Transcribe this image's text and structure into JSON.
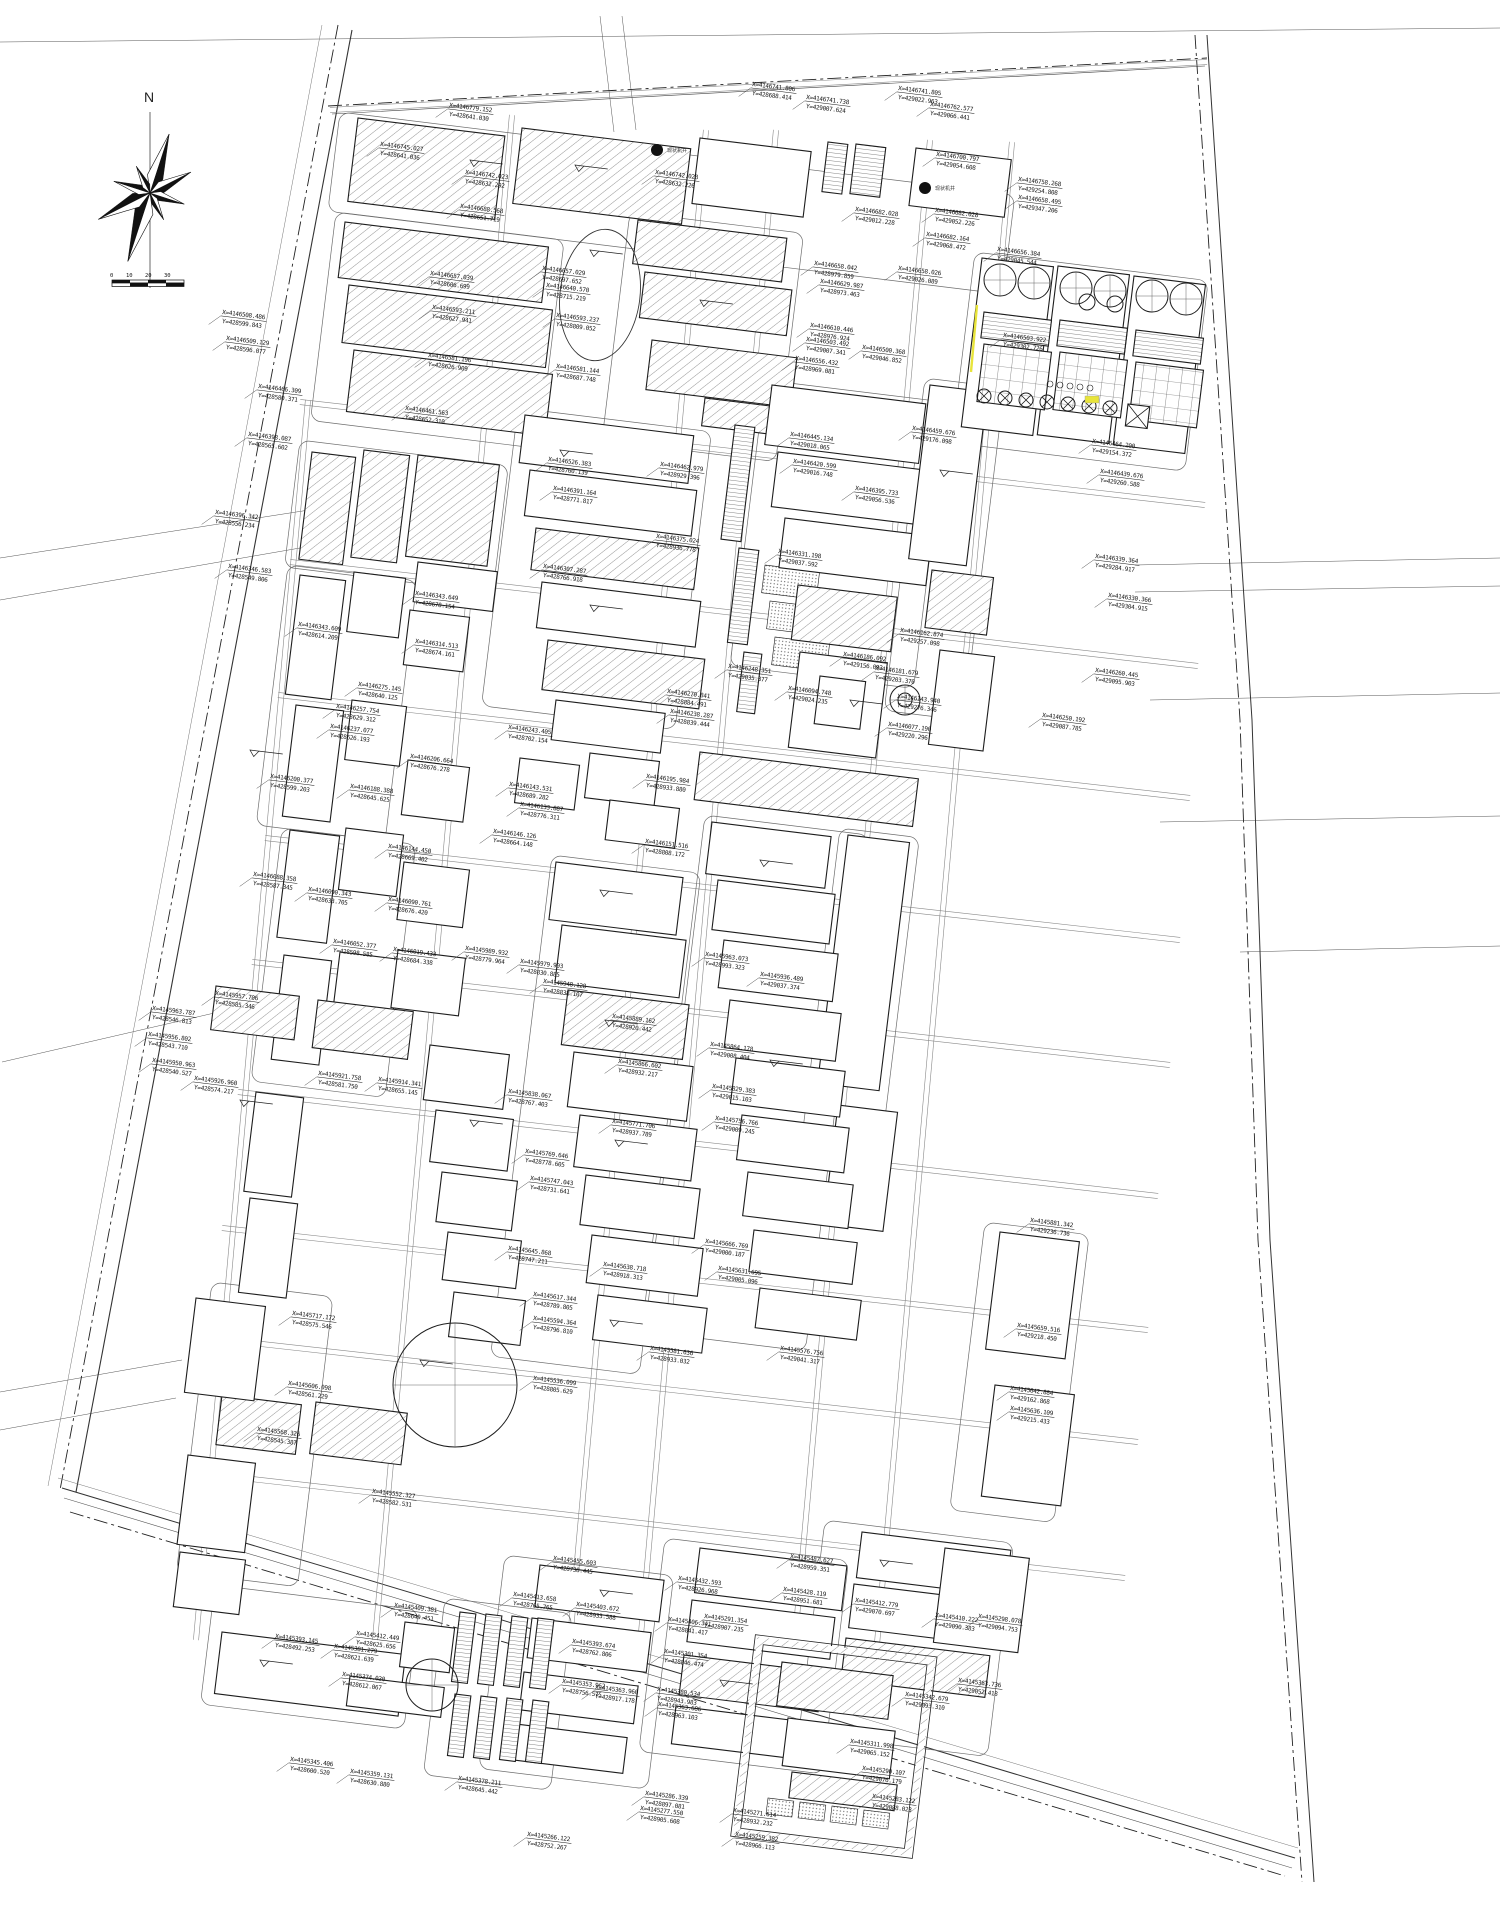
{
  "title": "industrial-plant-general-layout-site-plan",
  "compass": {
    "label": "N"
  },
  "scale_bar": {
    "ticks": [
      "0",
      "10",
      "20",
      "30"
    ]
  },
  "colors": {
    "background": "#ffffff",
    "line": "#1c1c1c",
    "road": "#8a8a8a",
    "highlight_yellow": "#e8e43a",
    "label_text": "#161616"
  },
  "markers": [
    {
      "x": 657,
      "y": 150,
      "text": "现状机井"
    },
    {
      "x": 925,
      "y": 188,
      "text": "现状机井"
    }
  ],
  "coordinate_label_fields": [
    "x",
    "y",
    "x_text",
    "y_text"
  ],
  "coordinate_labels": [
    [
      449,
      107,
      "X=4146779.152",
      "Y=428641.030"
    ],
    [
      380,
      146,
      "X=4146745.027",
      "Y=428641.036"
    ],
    [
      465,
      174,
      "X=4146742.023",
      "Y=428632.292"
    ],
    [
      655,
      174,
      "X=4146742.028",
      "Y=428632.226"
    ],
    [
      752,
      86,
      "X=4146741.806",
      "Y=428688.414"
    ],
    [
      806,
      99,
      "X=4146741.738",
      "Y=429007.624"
    ],
    [
      898,
      90,
      "X=4146741.805",
      "Y=429022.963"
    ],
    [
      930,
      106,
      "X=4146762.577",
      "Y=429066.441"
    ],
    [
      936,
      156,
      "X=4146700.797",
      "Y=429054.608"
    ],
    [
      1018,
      181,
      "X=4146758.268",
      "Y=429254.808"
    ],
    [
      1018,
      199,
      "X=4146658.495",
      "Y=429347.206"
    ],
    [
      460,
      208,
      "X=4146688.568",
      "Y=428651.719"
    ],
    [
      855,
      211,
      "X=4146682.028",
      "Y=429012.228"
    ],
    [
      935,
      212,
      "X=4146682.028",
      "Y=429052.226"
    ],
    [
      926,
      236,
      "X=4146682.164",
      "Y=429068.472"
    ],
    [
      997,
      251,
      "X=4146656.384",
      "Y=429045.544"
    ],
    [
      814,
      265,
      "X=4146658.042",
      "Y=428979.859"
    ],
    [
      898,
      270,
      "X=4146658.026",
      "Y=429026.089"
    ],
    [
      820,
      283,
      "X=4146629.987",
      "Y=428973.463"
    ],
    [
      430,
      275,
      "X=4146657.039",
      "Y=428606.699"
    ],
    [
      542,
      270,
      "X=4146657.029",
      "Y=428697.652"
    ],
    [
      546,
      287,
      "X=4146640.570",
      "Y=428715.219"
    ],
    [
      432,
      309,
      "X=4146593.211",
      "Y=428627.941"
    ],
    [
      556,
      317,
      "X=4146593.237",
      "Y=428809.052"
    ],
    [
      428,
      357,
      "X=4146581.196",
      "Y=428626.909"
    ],
    [
      556,
      368,
      "X=4146581.144",
      "Y=428687.748"
    ],
    [
      810,
      327,
      "X=4146610.446",
      "Y=428976.924"
    ],
    [
      795,
      360,
      "X=4146556.432",
      "Y=428969.081"
    ],
    [
      1003,
      337,
      "X=4146503.922",
      "Y=429302.726"
    ],
    [
      806,
      341,
      "X=4146503.492",
      "Y=429007.341"
    ],
    [
      862,
      349,
      "X=4146500.368",
      "Y=429046.852"
    ],
    [
      222,
      314,
      "X=4146508.486",
      "Y=428599.843"
    ],
    [
      226,
      340,
      "X=4146509.129",
      "Y=428596.077"
    ],
    [
      258,
      388,
      "X=4146466.309",
      "Y=428580.371"
    ],
    [
      248,
      436,
      "X=4146398.087",
      "Y=428565.602"
    ],
    [
      215,
      514,
      "X=4146396.342",
      "Y=428556.234"
    ],
    [
      228,
      568,
      "X=4146346.583",
      "Y=428549.806"
    ],
    [
      152,
      1010,
      "X=4145963.787",
      "Y=428546.813"
    ],
    [
      148,
      1036,
      "X=4145956.802",
      "Y=428543.710"
    ],
    [
      152,
      1062,
      "X=4145950.963",
      "Y=428540.527"
    ],
    [
      405,
      410,
      "X=4146461.563",
      "Y=428652.310"
    ],
    [
      415,
      595,
      "X=4146343.649",
      "Y=428678.154"
    ],
    [
      298,
      626,
      "X=4146343.609",
      "Y=428614.209"
    ],
    [
      415,
      643,
      "X=4146314.513",
      "Y=428674.161"
    ],
    [
      358,
      686,
      "X=4146275.145",
      "Y=428640.125"
    ],
    [
      336,
      708,
      "X=4146257.754",
      "Y=428629.312"
    ],
    [
      330,
      728,
      "X=4146237.077",
      "Y=428626.193"
    ],
    [
      410,
      758,
      "X=4146206.664",
      "Y=428676.278"
    ],
    [
      270,
      778,
      "X=4146200.377",
      "Y=428599.203"
    ],
    [
      350,
      788,
      "X=4146188.388",
      "Y=428645.625"
    ],
    [
      388,
      848,
      "X=4146144.450",
      "Y=428669.402"
    ],
    [
      253,
      876,
      "X=4146088.358",
      "Y=428587.345"
    ],
    [
      308,
      891,
      "X=4146090.343",
      "Y=428633.705"
    ],
    [
      388,
      901,
      "X=4146090.761",
      "Y=428676.420"
    ],
    [
      393,
      951,
      "X=4146019.433",
      "Y=428684.338"
    ],
    [
      548,
      461,
      "X=4146526.383",
      "Y=428760.139"
    ],
    [
      660,
      466,
      "X=4146462.979",
      "Y=428929.396"
    ],
    [
      553,
      490,
      "X=4146391.164",
      "Y=428771.817"
    ],
    [
      543,
      568,
      "X=4146307.287",
      "Y=428766.918"
    ],
    [
      656,
      538,
      "X=4146375.024",
      "Y=428936.778"
    ],
    [
      508,
      729,
      "X=4146243.405",
      "Y=428702.154"
    ],
    [
      509,
      786,
      "X=4146143.531",
      "Y=428689.282"
    ],
    [
      520,
      806,
      "X=4146133.887",
      "Y=428776.311"
    ],
    [
      493,
      833,
      "X=4146146.126",
      "Y=428664.148"
    ],
    [
      667,
      693,
      "X=4146270.841",
      "Y=428884.491"
    ],
    [
      670,
      713,
      "X=4146238.287",
      "Y=428839.444"
    ],
    [
      646,
      778,
      "X=4146195.984",
      "Y=428933.880"
    ],
    [
      645,
      843,
      "X=4146151.516",
      "Y=428808.172"
    ],
    [
      790,
      436,
      "X=4146445.134",
      "Y=429018.065"
    ],
    [
      793,
      463,
      "X=4146420.599",
      "Y=429016.748"
    ],
    [
      855,
      490,
      "X=4146395.733",
      "Y=429056.536"
    ],
    [
      912,
      430,
      "X=4146459.676",
      "Y=429176.098"
    ],
    [
      778,
      553,
      "X=4146331.198",
      "Y=429037.592"
    ],
    [
      843,
      656,
      "X=4146186.092",
      "Y=429156.093"
    ],
    [
      875,
      670,
      "X=4146181.679",
      "Y=429203.370"
    ],
    [
      728,
      668,
      "X=4146248.351",
      "Y=429035.377"
    ],
    [
      788,
      690,
      "X=4146094.748",
      "Y=429024.235"
    ],
    [
      897,
      698,
      "X=4146143.940",
      "Y=429276.346"
    ],
    [
      888,
      726,
      "X=4146077.190",
      "Y=429220.296"
    ],
    [
      900,
      632,
      "X=4146162.874",
      "Y=429257.098"
    ],
    [
      1092,
      443,
      "X=4146464.200",
      "Y=429154.372"
    ],
    [
      1100,
      473,
      "X=4146439.676",
      "Y=429260.588"
    ],
    [
      1095,
      558,
      "X=4146339.364",
      "Y=429284.917"
    ],
    [
      1108,
      597,
      "X=4146330.366",
      "Y=429304.915"
    ],
    [
      1095,
      672,
      "X=4146260.445",
      "Y=429095.903"
    ],
    [
      1042,
      717,
      "X=4146250.192",
      "Y=429087.785"
    ],
    [
      465,
      950,
      "X=4145989.932",
      "Y=428779.964"
    ],
    [
      520,
      963,
      "X=4145979.903",
      "Y=428830.885"
    ],
    [
      543,
      983,
      "X=4145948.128",
      "Y=428838.107"
    ],
    [
      705,
      956,
      "X=4145963.073",
      "Y=428993.323"
    ],
    [
      760,
      976,
      "X=4145936.489",
      "Y=429037.374"
    ],
    [
      612,
      1018,
      "X=4145889.162",
      "Y=428920.442"
    ],
    [
      618,
      1063,
      "X=4145866.602",
      "Y=428932.217"
    ],
    [
      710,
      1046,
      "X=4145864.178",
      "Y=429008.404"
    ],
    [
      508,
      1093,
      "X=4145838.067",
      "Y=428767.403"
    ],
    [
      712,
      1088,
      "X=4145829.383",
      "Y=429015.103"
    ],
    [
      612,
      1123,
      "X=4145771.706",
      "Y=428937.789"
    ],
    [
      715,
      1120,
      "X=4145756.766",
      "Y=429009.245"
    ],
    [
      525,
      1153,
      "X=4145769.646",
      "Y=428778.605"
    ],
    [
      530,
      1180,
      "X=4145747.043",
      "Y=428731.641"
    ],
    [
      508,
      1250,
      "X=4145645.868",
      "Y=428747.211"
    ],
    [
      603,
      1266,
      "X=4145638.718",
      "Y=428918.313"
    ],
    [
      705,
      1243,
      "X=4145666.769",
      "Y=429000.187"
    ],
    [
      718,
      1270,
      "X=4145631.695",
      "Y=429005.096"
    ],
    [
      533,
      1296,
      "X=4145617.344",
      "Y=428789.805"
    ],
    [
      533,
      1320,
      "X=4145594.364",
      "Y=428796.810"
    ],
    [
      650,
      1350,
      "X=4145581.636",
      "Y=428933.032"
    ],
    [
      533,
      1380,
      "X=4145536.099",
      "Y=428805.629"
    ],
    [
      780,
      1350,
      "X=4145576.756",
      "Y=429041.317"
    ],
    [
      333,
      943,
      "X=4146052.377",
      "Y=428598.585"
    ],
    [
      215,
      995,
      "X=4145957.706",
      "Y=428585.346"
    ],
    [
      194,
      1080,
      "X=4145926.960",
      "Y=428574.217"
    ],
    [
      318,
      1075,
      "X=4145921.758",
      "Y=428581.750"
    ],
    [
      378,
      1081,
      "X=4145914.341",
      "Y=428655.145"
    ],
    [
      1030,
      1222,
      "X=4145881.342",
      "Y=429236.736"
    ],
    [
      1017,
      1327,
      "X=4145659.516",
      "Y=429218.450"
    ],
    [
      1010,
      1390,
      "X=4145642.884",
      "Y=429162.868"
    ],
    [
      1010,
      1410,
      "X=4145636.109",
      "Y=429215.433"
    ],
    [
      292,
      1315,
      "X=4145717.172",
      "Y=428575.546"
    ],
    [
      288,
      1385,
      "X=4145606.098",
      "Y=428561.229"
    ],
    [
      257,
      1431,
      "X=4145568.326",
      "Y=428545.387"
    ],
    [
      372,
      1493,
      "X=4145552.327",
      "Y=428582.531"
    ],
    [
      275,
      1638,
      "X=4145393.145",
      "Y=428492.253"
    ],
    [
      394,
      1607,
      "X=4145409.381",
      "Y=428649.451"
    ],
    [
      356,
      1635,
      "X=4145412.449",
      "Y=428625.656"
    ],
    [
      334,
      1648,
      "X=4145381.279",
      "Y=428621.639"
    ],
    [
      342,
      1676,
      "X=4145374.030",
      "Y=428612.067"
    ],
    [
      290,
      1761,
      "X=4145345.406",
      "Y=428600.520"
    ],
    [
      350,
      1773,
      "X=4145359.131",
      "Y=428630.880"
    ],
    [
      458,
      1780,
      "X=4145378.211",
      "Y=428645.442"
    ],
    [
      553,
      1560,
      "X=4145455.603",
      "Y=428738.445"
    ],
    [
      678,
      1580,
      "X=4145432.593",
      "Y=428926.968"
    ],
    [
      790,
      1558,
      "X=4145487.627",
      "Y=428959.351"
    ],
    [
      783,
      1591,
      "X=4145428.119",
      "Y=428951.681"
    ],
    [
      513,
      1596,
      "X=4145413.658",
      "Y=428765.765"
    ],
    [
      576,
      1606,
      "X=4145403.672",
      "Y=428933.588"
    ],
    [
      572,
      1643,
      "X=4145393.674",
      "Y=428762.806"
    ],
    [
      668,
      1621,
      "X=4145406.341",
      "Y=428841.417"
    ],
    [
      704,
      1618,
      "X=4145291.354",
      "Y=428907.235"
    ],
    [
      664,
      1653,
      "X=4145301.354",
      "Y=428846.474"
    ],
    [
      562,
      1683,
      "X=4145353.962",
      "Y=428756.575"
    ],
    [
      595,
      1689,
      "X=4145363.960",
      "Y=428917.178"
    ],
    [
      657,
      1691,
      "X=4145380.534",
      "Y=428943.983"
    ],
    [
      658,
      1706,
      "X=4145363.686",
      "Y=428963.103"
    ],
    [
      855,
      1602,
      "X=4145412.779",
      "Y=429070.697"
    ],
    [
      935,
      1617,
      "X=4145410.222",
      "Y=429090.383"
    ],
    [
      978,
      1618,
      "X=4145298.078",
      "Y=429094.753"
    ],
    [
      958,
      1682,
      "X=4145363.736",
      "Y=429052.418"
    ],
    [
      645,
      1795,
      "X=4145286.339",
      "Y=428897.081"
    ],
    [
      640,
      1810,
      "X=4145277.550",
      "Y=428905.608"
    ],
    [
      733,
      1812,
      "X=4145271.614",
      "Y=428932.232"
    ],
    [
      527,
      1836,
      "X=4145266.122",
      "Y=428752.267"
    ],
    [
      850,
      1743,
      "X=4145311.998",
      "Y=429065.152"
    ],
    [
      862,
      1770,
      "X=4145290.107",
      "Y=429076.179"
    ],
    [
      872,
      1798,
      "X=4145283.122",
      "Y=429088.023"
    ],
    [
      735,
      1836,
      "X=4145259.382",
      "Y=428966.113"
    ],
    [
      905,
      1696,
      "X=4145342.679",
      "Y=429093.310"
    ]
  ]
}
